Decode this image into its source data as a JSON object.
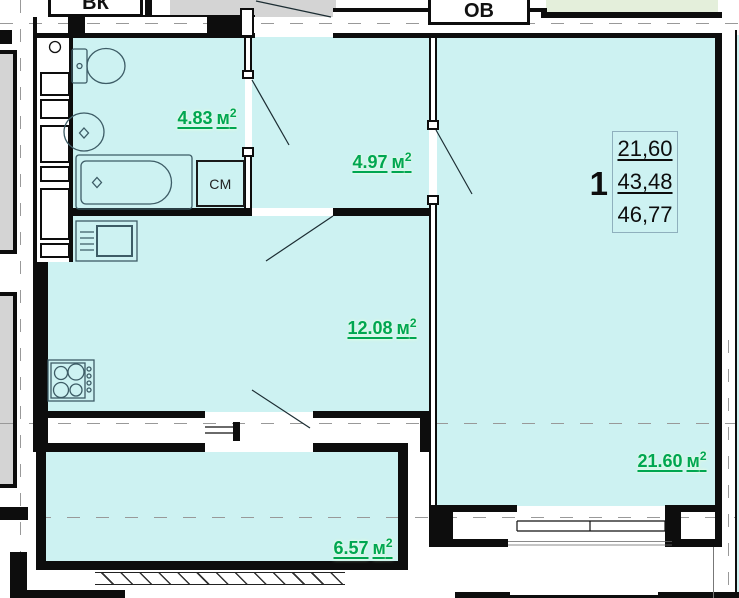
{
  "shafts": {
    "water": "ВК",
    "heating": "ОВ"
  },
  "appliances": {
    "washing_machine_label": "СМ"
  },
  "rooms": [
    {
      "id": "bathroom",
      "area": "4.83",
      "unit": "м",
      "power": "2"
    },
    {
      "id": "hallway",
      "area": "4.97",
      "unit": "м",
      "power": "2"
    },
    {
      "id": "kitchen",
      "area": "12.08",
      "unit": "м",
      "power": "2"
    },
    {
      "id": "living-room",
      "area": "21.60",
      "unit": "м",
      "power": "2"
    },
    {
      "id": "balcony",
      "area": "6.57",
      "unit": "м",
      "power": "2"
    }
  ],
  "stamp": {
    "rooms_count": "1",
    "living_area": "21,60",
    "apartment_area": "43,48",
    "total_area": "46,77"
  },
  "colors": {
    "room_fill": "#cdf2f2",
    "neighbor_fill": "#e4efdb",
    "stairwell_fill": "#d4d4d4",
    "wall": "#0d0d0d",
    "area_label_green": "#00a651"
  }
}
